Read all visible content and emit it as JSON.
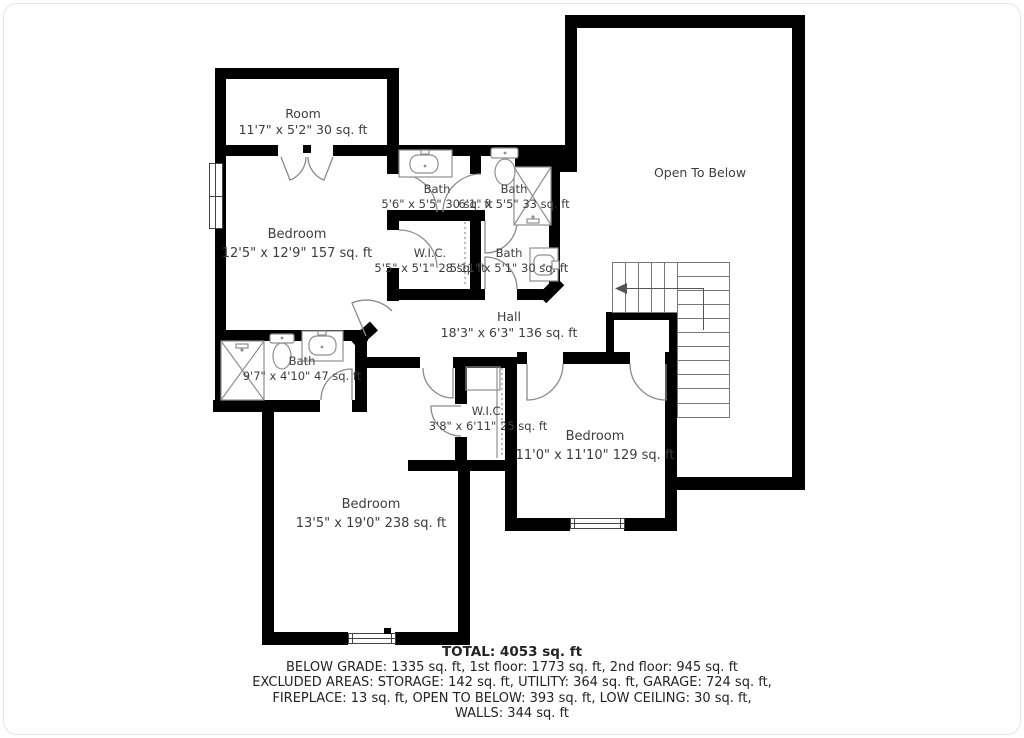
{
  "plan": {
    "floor": "2nd floor",
    "rooms": [
      {
        "name": "Room",
        "dims": "11'7\" x 5'2\" 30 sq. ft"
      },
      {
        "name": "Bedroom",
        "dims": "12'5\" x 12'9\" 157 sq. ft"
      },
      {
        "name": "Bath",
        "dims": "5'6\" x 5'5\" 30 sq. ft"
      },
      {
        "name": "Bath",
        "dims": "6'1\" x 5'5\" 33 sq. ft"
      },
      {
        "name": "W.I.C.",
        "dims": "5'5\" x 5'1\" 28 sq. ft"
      },
      {
        "name": "Bath",
        "dims": "5'11\" x 5'1\" 30 sq. ft"
      },
      {
        "name": "Open To Below",
        "dims": ""
      },
      {
        "name": "Hall",
        "dims": "18'3\" x 6'3\" 136 sq. ft"
      },
      {
        "name": "Bath",
        "dims": "9'7\" x 4'10\" 47 sq. ft"
      },
      {
        "name": "W.I.C.",
        "dims": "3'8\" x 6'11\" 25 sq. ft"
      },
      {
        "name": "Bedroom",
        "dims": "11'0\" x 11'10\" 129 sq. ft"
      },
      {
        "name": "Bedroom",
        "dims": "13'5\" x 19'0\" 238 sq. ft"
      }
    ],
    "summary": {
      "total": "TOTAL: 4053 sq. ft",
      "line1": "BELOW GRADE: 1335 sq. ft, 1st floor: 1773 sq. ft, 2nd floor: 945 sq. ft",
      "line2": "EXCLUDED AREAS: STORAGE: 142 sq. ft, UTILITY: 364 sq. ft, GARAGE: 724 sq. ft,",
      "line3": "FIREPLACE: 13 sq. ft, OPEN TO BELOW: 393 sq. ft, LOW CEILING: 30 sq. ft,",
      "line4": "WALLS: 344 sq. ft"
    },
    "colors": {
      "wall": "#000000",
      "fixture_line": "#8f8f8f",
      "stair_line": "#6f6f6f",
      "text": "#3d3d3d"
    }
  }
}
